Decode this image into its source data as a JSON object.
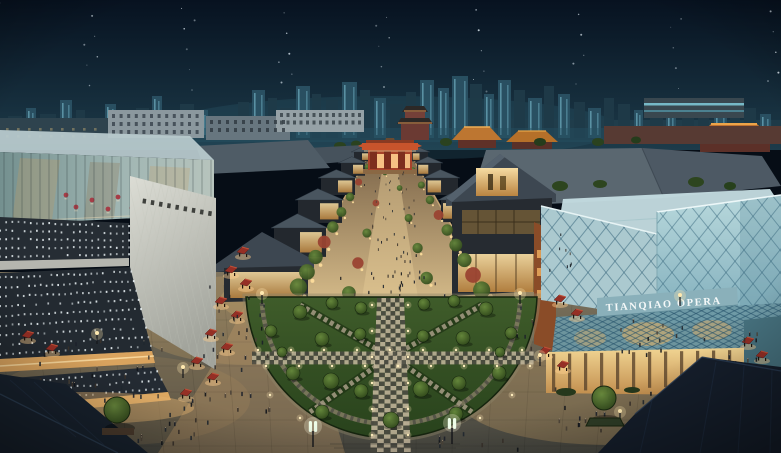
{
  "meta": {
    "description": "Night-time aerial architectural rendering of the Tianqiao performing-arts district: a tree-lined pedestrian street runs from a semicircular lawn plaza up to a red traditional gate; an LED-dot museum block stands left, the glass Tianqiao Opera house right, with temple roofs and a lit high-rise skyline behind under a dark navy sky."
  },
  "signs": {
    "opera_sign": "TIANQIAO OPERA"
  },
  "palette": {
    "sky_top": "#071220",
    "sky_bottom": "#1d3b4a",
    "skyline": "#1f3a48",
    "skyline_lit": "#2a5163",
    "window_glow": "#8ad2e4",
    "temple_roof": "#bf7230",
    "gate_red": "#c8542c",
    "glass_teal": "#9cc2cc",
    "white_parapet": "#d6d8d0",
    "museum_panel": "#262d34",
    "led_dot": "#e9f1f4",
    "street_warm": "#d2b887",
    "shop_glow": "#f2c477",
    "lawn": "#3a5526",
    "tree_green": "#2c4419",
    "canopy_red": "#952f25",
    "plaza": "#7d725c",
    "dark_roof": "#18222e",
    "lamp": "#fff6dc"
  },
  "scene": {
    "stars": {
      "count": 46
    },
    "skyline_towers": [
      [
        8,
        14,
        22,
        0
      ],
      [
        26,
        10,
        30,
        1
      ],
      [
        40,
        16,
        24,
        0
      ],
      [
        60,
        12,
        38,
        1
      ],
      [
        76,
        9,
        28,
        0
      ],
      [
        88,
        14,
        20,
        0
      ],
      [
        105,
        11,
        34,
        1
      ],
      [
        120,
        8,
        26,
        0
      ],
      [
        136,
        13,
        30,
        0
      ],
      [
        152,
        10,
        42,
        1
      ],
      [
        165,
        9,
        24,
        0
      ],
      [
        180,
        14,
        34,
        0
      ],
      [
        198,
        10,
        28,
        1
      ],
      [
        214,
        12,
        22,
        0
      ],
      [
        238,
        11,
        36,
        0
      ],
      [
        252,
        13,
        48,
        1
      ],
      [
        268,
        9,
        40,
        0
      ],
      [
        280,
        12,
        30,
        0
      ],
      [
        296,
        14,
        52,
        1
      ],
      [
        312,
        9,
        44,
        0
      ],
      [
        326,
        12,
        38,
        0
      ],
      [
        342,
        15,
        56,
        1
      ],
      [
        360,
        10,
        48,
        0
      ],
      [
        374,
        12,
        40,
        1
      ],
      [
        390,
        13,
        34,
        0
      ],
      [
        406,
        10,
        46,
        0
      ],
      [
        420,
        14,
        58,
        1
      ],
      [
        438,
        11,
        50,
        1
      ],
      [
        452,
        16,
        62,
        1
      ],
      [
        470,
        12,
        54,
        0
      ],
      [
        484,
        10,
        44,
        1
      ],
      [
        498,
        13,
        58,
        1
      ],
      [
        514,
        11,
        48,
        0
      ],
      [
        528,
        14,
        40,
        1
      ],
      [
        544,
        10,
        52,
        0
      ],
      [
        558,
        12,
        44,
        1
      ],
      [
        574,
        11,
        36,
        0
      ],
      [
        588,
        13,
        30,
        1
      ],
      [
        604,
        10,
        40,
        0
      ],
      [
        618,
        12,
        34,
        0
      ],
      [
        634,
        9,
        28,
        1
      ],
      [
        650,
        13,
        38,
        0
      ],
      [
        666,
        10,
        32,
        1
      ],
      [
        682,
        12,
        26,
        0
      ],
      [
        698,
        11,
        34,
        0
      ],
      [
        714,
        13,
        28,
        1
      ],
      [
        730,
        10,
        22,
        0
      ],
      [
        744,
        12,
        30,
        0
      ],
      [
        760,
        11,
        24,
        1
      ],
      [
        772,
        9,
        18,
        0
      ]
    ],
    "window_grids": [
      {
        "x": 112,
        "y": 114,
        "cols": 12,
        "rows": 3,
        "dx": 7.6,
        "dy": 8,
        "w": 3,
        "h": 4,
        "fill": "#36414a",
        "op": 0.8
      },
      {
        "x": 210,
        "y": 120,
        "cols": 10,
        "rows": 2,
        "dx": 8,
        "dy": 8,
        "w": 3,
        "h": 4,
        "fill": "#2e3840",
        "op": 0.8
      },
      {
        "x": 280,
        "y": 113,
        "cols": 13,
        "rows": 2,
        "dx": 6.5,
        "dy": 7.5,
        "w": 3,
        "h": 4,
        "fill": "#39444a",
        "op": 0.85
      },
      {
        "x": 608,
        "y": 129,
        "cols": 20,
        "rows": 2,
        "dx": 8.6,
        "dy": 7,
        "w": 3.4,
        "h": 3.2,
        "fill": "#e8b26a",
        "op": 0.5
      },
      {
        "x": 702,
        "y": 143,
        "cols": 8,
        "rows": 1,
        "dx": 8.6,
        "dy": 6,
        "w": 3,
        "h": 3,
        "fill": "#f0c070",
        "op": 0.5
      },
      {
        "x": 6,
        "y": 128,
        "cols": 9,
        "rows": 2,
        "dx": 11,
        "dy": 7,
        "w": 2.6,
        "h": 2.6,
        "fill": "#d8b87a",
        "op": 0.4
      }
    ],
    "led_bands": [
      {
        "t": [
          [
            0,
            217
          ],
          [
            129,
            223
          ]
        ],
        "b": [
          [
            0,
            261
          ],
          [
            129,
            258
          ]
        ],
        "rows": 5,
        "cols": 22
      },
      {
        "t": [
          [
            0,
            273
          ],
          [
            130,
            267
          ]
        ],
        "b": [
          [
            0,
            359
          ],
          [
            152,
            351
          ]
        ],
        "rows": 9,
        "cols": 24
      },
      {
        "t": [
          [
            0,
            379
          ],
          [
            155,
            367
          ]
        ],
        "b": [
          [
            0,
            407
          ],
          [
            168,
            392
          ]
        ],
        "rows": 3,
        "cols": 26
      }
    ],
    "umbrellas": [
      [
        66,
        195
      ],
      [
        92,
        200
      ],
      [
        118,
        197
      ],
      [
        145,
        203
      ],
      [
        168,
        201
      ],
      [
        188,
        204
      ],
      [
        76,
        207
      ],
      [
        108,
        209
      ],
      [
        132,
        208
      ]
    ],
    "street": {
      "left": [
        [
          354,
          152,
          16,
          11
        ],
        [
          341,
          163,
          24,
          15
        ],
        [
          321,
          178,
          34,
          20
        ],
        [
          298,
          200,
          44,
          27
        ],
        [
          274,
          228,
          52,
          34
        ],
        [
          248,
          260,
          60,
          40
        ]
      ],
      "right": [
        [
          412,
          152,
          16,
          11
        ],
        [
          417,
          163,
          24,
          15
        ],
        [
          426,
          178,
          32,
          20
        ],
        [
          441,
          200,
          40,
          26
        ]
      ]
    },
    "lawn_trees": [
      [
        300,
        312,
        7
      ],
      [
        332,
        303,
        6
      ],
      [
        361,
        308,
        6
      ],
      [
        424,
        304,
        6
      ],
      [
        454,
        301,
        6
      ],
      [
        486,
        309,
        7
      ],
      [
        271,
        331,
        6
      ],
      [
        322,
        339,
        7
      ],
      [
        360,
        334,
        6
      ],
      [
        423,
        336,
        6
      ],
      [
        463,
        338,
        7
      ],
      [
        511,
        333,
        6
      ],
      [
        293,
        373,
        7
      ],
      [
        331,
        381,
        8
      ],
      [
        361,
        391,
        7
      ],
      [
        421,
        389,
        8
      ],
      [
        459,
        383,
        7
      ],
      [
        499,
        373,
        7
      ],
      [
        322,
        412,
        7
      ],
      [
        391,
        420,
        8
      ],
      [
        456,
        414,
        7
      ],
      [
        282,
        352,
        5
      ],
      [
        500,
        352,
        5
      ]
    ],
    "stalls": [
      [
        243,
        252
      ],
      [
        231,
        271
      ],
      [
        246,
        284
      ],
      [
        221,
        302
      ],
      [
        237,
        316
      ],
      [
        211,
        334
      ],
      [
        227,
        348
      ],
      [
        197,
        362
      ],
      [
        213,
        378
      ],
      [
        186,
        394
      ],
      [
        28,
        336
      ],
      [
        52,
        349
      ],
      [
        560,
        300
      ],
      [
        577,
        314
      ],
      [
        748,
        342
      ],
      [
        762,
        356
      ],
      [
        545,
        352
      ],
      [
        563,
        366
      ]
    ],
    "lamps": {
      "twin": [
        [
          313,
          431
        ],
        [
          452,
          428
        ]
      ],
      "warm": [
        [
          183,
          374
        ],
        [
          620,
          418
        ],
        [
          680,
          302
        ],
        [
          97,
          340
        ],
        [
          540,
          362
        ],
        [
          262,
          300
        ],
        [
          520,
          300
        ]
      ]
    },
    "people_clusters": [
      [
        390,
        238,
        26,
        52,
        40
      ],
      [
        390,
        286,
        55,
        13,
        16
      ],
      [
        100,
        373,
        62,
        30,
        26
      ],
      [
        213,
        413,
        56,
        25,
        20
      ],
      [
        226,
        330,
        26,
        44,
        16
      ],
      [
        480,
        444,
        44,
        8,
        10
      ],
      [
        612,
        416,
        62,
        27,
        22
      ],
      [
        662,
        341,
        46,
        21,
        14
      ],
      [
        748,
        352,
        26,
        16,
        8
      ],
      [
        263,
        331,
        9,
        29,
        6
      ],
      [
        524,
        331,
        9,
        29,
        6
      ],
      [
        390,
        181,
        16,
        12,
        10
      ],
      [
        160,
        443,
        40,
        9,
        8
      ],
      [
        700,
        443,
        50,
        9,
        8
      ],
      [
        560,
        260,
        14,
        24,
        8
      ]
    ]
  }
}
